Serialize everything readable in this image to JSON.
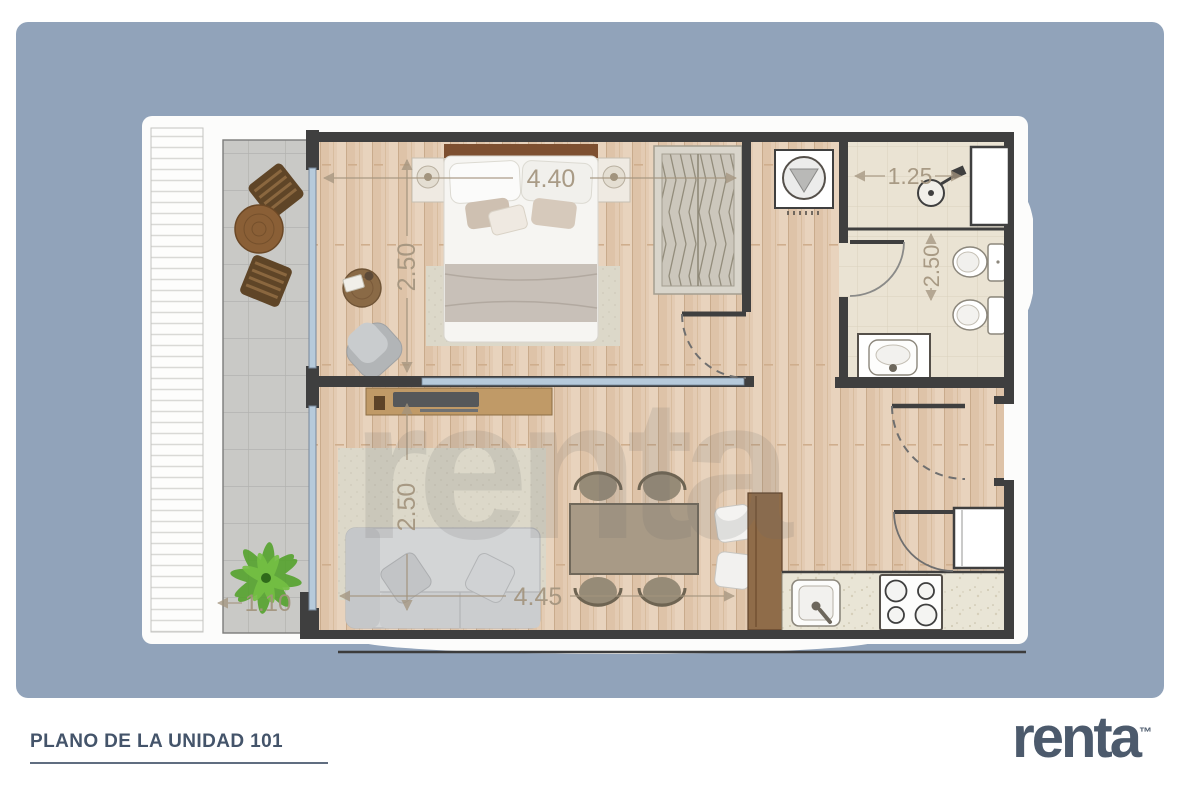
{
  "panel": {
    "bg_color": "#91a3ba"
  },
  "footer": {
    "title": "PLANO DE LA UNIDAD 101",
    "brand": "renta",
    "brand_tm": "™"
  },
  "floorplan": {
    "watermark": "renta",
    "dims": {
      "bedroom_width": "4.40",
      "bedroom_depth": "2.50",
      "shower_width": "1.25",
      "bathroom_depth": "2.50",
      "living_depth": "2.50",
      "living_width": "4.45",
      "balcony_width": "1.10"
    },
    "colors": {
      "wall": "#3f3f3f",
      "wood_floor": "#e2cab2",
      "balcony_tile": "#c9c9c6",
      "glass": "#b6cadb",
      "dim_text": "#a3947e",
      "title_text": "#44546a",
      "logo_text": "#4c5a6c"
    }
  }
}
